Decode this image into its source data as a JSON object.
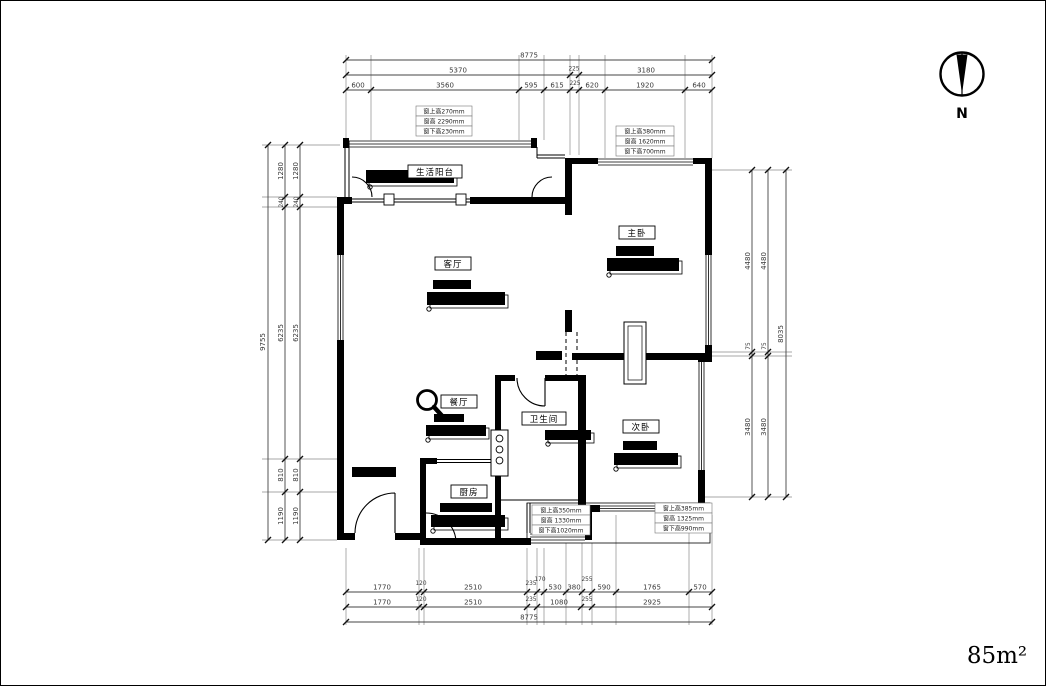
{
  "compass": {
    "label": "N"
  },
  "area_label": "85m²",
  "rooms": {
    "balcony": "生活阳台",
    "living": "客厅",
    "master": "主卧",
    "dining": "餐厅",
    "bathroom": "卫生间",
    "second_bedroom": "次卧",
    "kitchen": "厨房"
  },
  "window_notes": {
    "top_left": [
      "窗上高270mm",
      "窗高 2290mm",
      "窗下高230mm"
    ],
    "top_right": [
      "窗上高380mm",
      "窗高 1620mm",
      "窗下高700mm"
    ],
    "bottom_left": [
      "窗上高350mm",
      "窗高 1330mm",
      "窗下高1020mm"
    ],
    "bottom_right": [
      "窗上高385mm",
      "窗高 1325mm",
      "窗下高990mm"
    ]
  },
  "dims": {
    "top": {
      "total": "8775",
      "row2": [
        "5370",
        "225",
        "3180"
      ],
      "row3": [
        "600",
        "3560",
        "595",
        "615",
        "225",
        "620",
        "1920",
        "640"
      ]
    },
    "bottom": {
      "row1": [
        "1770",
        "120",
        "2510",
        "235",
        "170",
        "530",
        "380",
        "255",
        "590",
        "1765",
        "570"
      ],
      "row2": [
        "1770",
        "120",
        "2510",
        "235",
        "1080",
        "255",
        "2925"
      ],
      "total": "8775"
    },
    "left": {
      "total": "9755",
      "chain": [
        "1280",
        "240",
        "6235",
        "810",
        "1190"
      ]
    },
    "right": {
      "total": "8035",
      "chain": [
        "4480",
        "75",
        "3480"
      ]
    }
  },
  "colors": {
    "wall": "#000000",
    "dim_line": "#444444",
    "dim_text": "#3a3a3a",
    "background": "#ffffff"
  }
}
